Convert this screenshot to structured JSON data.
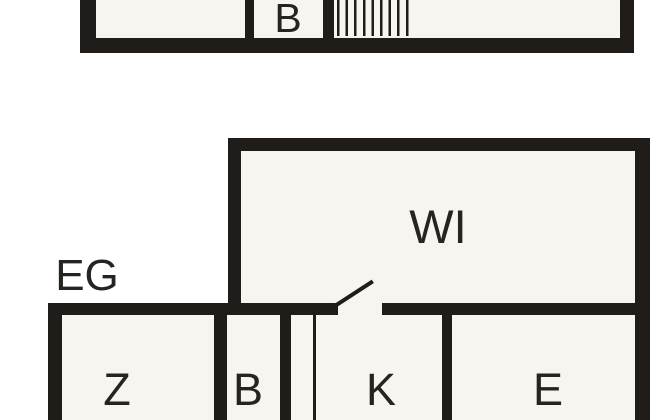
{
  "colors": {
    "background": "#ffffff",
    "room_fill": "#f6f5ef",
    "wall": "#1f1c19",
    "text": "#262421"
  },
  "upper_floor": {
    "rooms": {
      "b": "B"
    }
  },
  "ground_floor": {
    "floor_label": "EG",
    "rooms": {
      "wi": "WI",
      "z": "Z",
      "b": "B",
      "k": "K",
      "e": "E"
    }
  }
}
